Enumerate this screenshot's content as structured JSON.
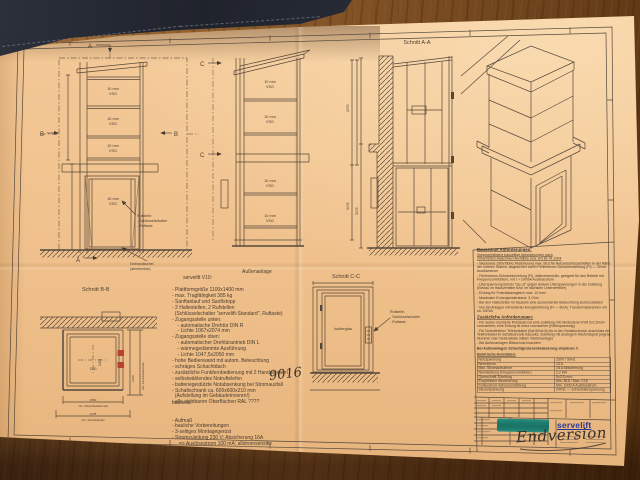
{
  "markers": {
    "a": "A",
    "b": "B",
    "c": "C"
  },
  "glass": {
    "l1": "10 mm",
    "l2": "VSG"
  },
  "view_titles": {
    "aa": "Schnitt A-A",
    "bb": "Schnitt B-B",
    "cc": "Schnitt C-C"
  },
  "rufstelle": {
    "t": "Rufstelle:",
    "i1": "- Schlüsselschalter",
    "i2": "- Ruftaste"
  },
  "front": {
    "crank1": "Nothandkurbel",
    "crank2": "(abnehmbar)"
  },
  "cc": {
    "glass": "Isolierglas"
  },
  "dims": {
    "h1": "2075",
    "h2": "3005",
    "bb_w": "1100",
    "bb_h": "1400",
    "bb_o1": "1560",
    "bb_o1l": "min. Schachtaußenmaß",
    "bb_o2": "1478",
    "bb_o2l": "min. Schachtgrube",
    "bb_sl": "min. Schachtaußenmaß"
  },
  "spec": {
    "title": "servelift V10:",
    "subtitle": "Außenanlage",
    "lines": [
      "- Plattformgröße 1100x1400 mm",
      "- max. Tragfähigkeit 385 kg",
      "- Sanftanlauf und Sanftstopp",
      "- 2 Haltestellen, 2 Rufstellen",
      "  (Schlüsselschalter \"servelift-Standard\", Ruftaste)",
      "- Zugangsstelle unten:",
      "    - automatische Drehtür DIN R",
      "    - Lichte 1067x2074 mm",
      "- Zugangsstelle oben:",
      "    - automatischer Drehtürantrieb DIN L",
      "    - wärmegedämmte Ausführung",
      "    - Lichte 1047,5x2050 mm",
      "- hohe Bedienwand mit autom. Beleuchtung",
      "- schräges Schachtdach",
      "- zusätzliche Funkfernbedienung mit 2 Handsendern",
      "- selbstwählendes Notruftelefon",
      "- batteriegestützte Notabsenkung bei Stromausfall",
      "- Schaltschrank ca. 600x600x210 mm",
      "  (Aufstellung im Gebäudeinneren!)",
      "- alle sichtbaren Oberflächen RAL ????"
    ],
    "ral_note": "9016"
  },
  "bauseits": {
    "title": "bauseits:",
    "lines": [
      "- Aufmaß",
      "- bauliche Vorbereitungen",
      "- 3-seitiges Montagegerüst",
      "- Stromzuleitung 230 V; Absicherung 16A",
      "     => Auslösestrom 100 mA; allstromsensitiv"
    ]
  },
  "req": {
    "heading": "Bauseitige Anforderungen:",
    "intro": [
      "Vorgeschriebene bauseitige Anforderungen nach",
      "2006/42/EG Maschinen-Richtlinie bzw. EN 81-41:2004"
    ],
    "items": [
      "- Steckdose 230V/50Hz Absicherung max. B13 für Netzanschlussarbeiten in der Nähe der unteren Station, abgesichert durch Fehlerstrom-Schutzeinrichtung (FI) — 30mA Auslösestrom",
      "- Fehlerstrom-Schutzeinrichtung (FI), allstromsensitiv, geeignet für den Betrieb mit Frequenzumrichtern, mit I > 100mA Auslösestrom",
      "- Überspannungsschutz Typ „D\" gegen äußere Überspannungen in der Zuleitung (Einbau im Hausverteiler bzw. im nächsten Unterverteiler)",
      "- Erdung für Potentialausgleich max. 10 mm²",
      "- Maximaler Erdungswiderstand: 3 Ohm",
      "- Bei den Haltestellen ist bauseits eine ausreichende Beleuchtung sicherzustellen",
      "- Nur bei Anlagen mit isolierter Energieführung (FI — 6mA): Transformatorenbox mit ca. 400VA"
    ],
    "add_heading": "Zusätzliche Anforderungen:",
    "add_items": [
      "- Für außen montierte Rufsäulen ist eine Zuleitung mit mindestens NYM 5x1,5mm² vorzusehen; eine Erdung ist extra vorzusehen (Kleinspannung)",
      "- Für Notruftelefon: Telefonkabel (Kat.5/Kat.6) bis in den Schaltschrank; Anschluss der Telefonkabel im Schaltschrank bauseits; Zuleitung mit analogem Telefonsignal (eigene Nummer oder Nebenstelle mittels Telefonanlage)",
      "- Bei Außenanlagen Blitzschutz beachten"
    ],
    "bold_note": "Bei Außenanlagen Schachtgrubenentwässerung einplanen !!",
    "elec_heading": "Elektrische Kenndaten:",
    "elec_rows": [
      {
        "k": "Netzspannung",
        "v": "230V / 50Hz"
      },
      {
        "k": "Nennstrom",
        "v": "13 A"
      },
      {
        "k": "Max. Stromaufnahme",
        "v": "16 A Absicherung"
      },
      {
        "k": "Nennleistung (Frequenzumrichter)",
        "v": "2,2 kW"
      },
      {
        "k": "Querschnitt Zuleitung",
        "v": "5x2,5 mm²"
      },
      {
        "k": "Empfohlene Absicherung",
        "v": "Min. B16 / Max. C16"
      },
      {
        "k": "Fehlerstrom-Schutzeinrichtung",
        "v": "Min. 100mA Auslösestrom"
      },
      {
        "k": "Steuerspannung",
        "v": "24Vdc — Schutzkleinspannung"
      }
    ]
  },
  "titleblock": {
    "logo": "servelift",
    "handwritten": "Endversion"
  }
}
